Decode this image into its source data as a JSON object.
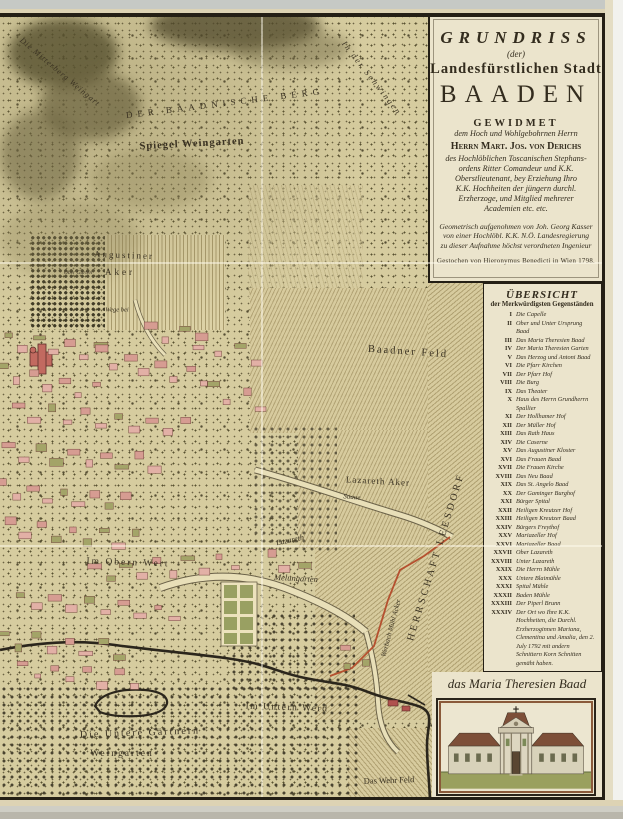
{
  "map_title": "Grundriss der Landesfürstlichen Stadt Baaden",
  "cartouche": {
    "title_top": "GRUNDRISS",
    "title_der": "(der)",
    "title_mid": "Landesfürstlichen Stadt",
    "title_main": "BAADEN",
    "dedication_heading": "GEWIDMET",
    "dedication_to": "dem Hoch und Wohlgebohrnen Herrn",
    "dedicatee": "Herrn Mart. Jos. von Derichs",
    "dedication_body": [
      "des Hochlöblichen Toscanischen Stephans-",
      "ordens Ritter Comandeur und K.K.",
      "Oberstlieutenant, bey Erziehung Ihro",
      "K.K. Hochheiten der jüngern durchl.",
      "Erzherzoge, und Mitglied mehrerer",
      "Academien etc. etc."
    ],
    "surveyor_note": [
      "Geometrisch aufgenohmen von Joh. Georg Kasser",
      "von einer Hochlöbl. K.K. N.Ö. Landesregierung",
      "zu dieser Aufnahme höchst verordneten Ingenieur"
    ],
    "engraver_note": "Gestochen von Hieronymus Benedicti in Wien 1798."
  },
  "legend": {
    "title": "ÜBERSICHT",
    "subtitle": "der Merkwürdigsten Gegenständen",
    "items": [
      {
        "numeral": "I",
        "label": "Die Capelle"
      },
      {
        "numeral": "II",
        "label": "Ober und Unter Ursprung Baad"
      },
      {
        "numeral": "III",
        "label": "Das Maria Theresien Baad"
      },
      {
        "numeral": "IV",
        "label": "Der Maria Theresien Garten"
      },
      {
        "numeral": "V",
        "label": "Das Herzog und Antoni Baad"
      },
      {
        "numeral": "VI",
        "label": "Die Pfarr Kirchen"
      },
      {
        "numeral": "VII",
        "label": "Der Pfarr Hof"
      },
      {
        "numeral": "VIII",
        "label": "Die Burg"
      },
      {
        "numeral": "IX",
        "label": "Das Theater"
      },
      {
        "numeral": "X",
        "label": "Haus des Herrn Grundherrn Spallier"
      },
      {
        "numeral": "XI",
        "label": "Der Hollhamer Hof"
      },
      {
        "numeral": "XII",
        "label": "Der Müller Hof"
      },
      {
        "numeral": "XIII",
        "label": "Das Rath Haus"
      },
      {
        "numeral": "XIV",
        "label": "Die Caserne"
      },
      {
        "numeral": "XV",
        "label": "Das Augustiner Kloster"
      },
      {
        "numeral": "XVI",
        "label": "Das Frauen Baad"
      },
      {
        "numeral": "XVII",
        "label": "Die Frauen Kirche"
      },
      {
        "numeral": "XVIII",
        "label": "Das Neu Baad"
      },
      {
        "numeral": "XIX",
        "label": "Das St. Angelo Baad"
      },
      {
        "numeral": "XX",
        "label": "Der Gaminger Burghof"
      },
      {
        "numeral": "XXI",
        "label": "Bürger Spital"
      },
      {
        "numeral": "XXII",
        "label": "Heiligen Kreutzer Hof"
      },
      {
        "numeral": "XXIII",
        "label": "Heiligen Kreutzer Baad"
      },
      {
        "numeral": "XXIV",
        "label": "Bürgers Freythof"
      },
      {
        "numeral": "XXV",
        "label": "Mariazeller Hof"
      },
      {
        "numeral": "XXVI",
        "label": "Mariazeller Baad"
      },
      {
        "numeral": "XXVII",
        "label": "Ober Lazareth"
      },
      {
        "numeral": "XXVIII",
        "label": "Unter Lazareth"
      },
      {
        "numeral": "XXIX",
        "label": "Die Herrn Mühle"
      },
      {
        "numeral": "XXX",
        "label": "Untere Blaimühle"
      },
      {
        "numeral": "XXXI",
        "label": "Spital Mühle"
      },
      {
        "numeral": "XXXII",
        "label": "Baden Mühle"
      },
      {
        "numeral": "XXXIII",
        "label": "Der Piperl Brunn"
      },
      {
        "numeral": "XXXIV",
        "label": "Der Ort wo Ihre K.K. Hochheiten, die Durchl. Erzherzoginnen Mariana, Clementina und Amalia, den 2. July 1792 mit andern Schnittern Korn Schnitten gemäht haben."
      }
    ]
  },
  "vignette": {
    "caption": "das Maria Theresien Baad"
  },
  "map_labels": [
    {
      "id": "mitterberg-weingart",
      "text": "Die Mitterberg Weingart"
    },
    {
      "id": "badnische-berg",
      "text": "DER BAADNISCHE BERG"
    },
    {
      "id": "spiegel-weingarten",
      "text": "Spiegel Weingarten"
    },
    {
      "id": "in-der-schwingen",
      "text": "In der Schwingen"
    },
    {
      "id": "augustiner",
      "text": "Augustiner"
    },
    {
      "id": "aker",
      "text": "Aker"
    },
    {
      "id": "ober-garten",
      "text": "Ober Garten"
    },
    {
      "id": "wege-bei",
      "text": "Wege bei"
    },
    {
      "id": "baadner-feld",
      "text": "Baadner Feld"
    },
    {
      "id": "lazareth-aker",
      "text": "Lazareth Aker"
    },
    {
      "id": "saaue",
      "text": "Saaue"
    },
    {
      "id": "lazareth",
      "text": "Lazareth"
    },
    {
      "id": "im-obern-wert",
      "text": "Im Obern Wert"
    },
    {
      "id": "melungarten",
      "text": "Melungarten"
    },
    {
      "id": "werbach-muehl-acker",
      "text": "Werbach Mühl Acker"
    },
    {
      "id": "herrschaft-leesdorf",
      "text": "HERRSCHAFT LEESDORF"
    },
    {
      "id": "im-untern-werd",
      "text": "Im Untern Werd"
    },
    {
      "id": "die-untere-gaertnern",
      "text": "Die Untere Gärtnern"
    },
    {
      "id": "weingarten",
      "text": "Weingarten"
    },
    {
      "id": "das-wehr-feld",
      "text": "Das Wehr Feld"
    }
  ],
  "colors": {
    "paper": "#d6cc9f",
    "panel": "#ebe4cc",
    "ink": "#332c1e",
    "building_pink": "#e2b0a6",
    "garden_green": "#a3a468",
    "boundary_red": "#b5502f",
    "river": "#2b261c"
  }
}
